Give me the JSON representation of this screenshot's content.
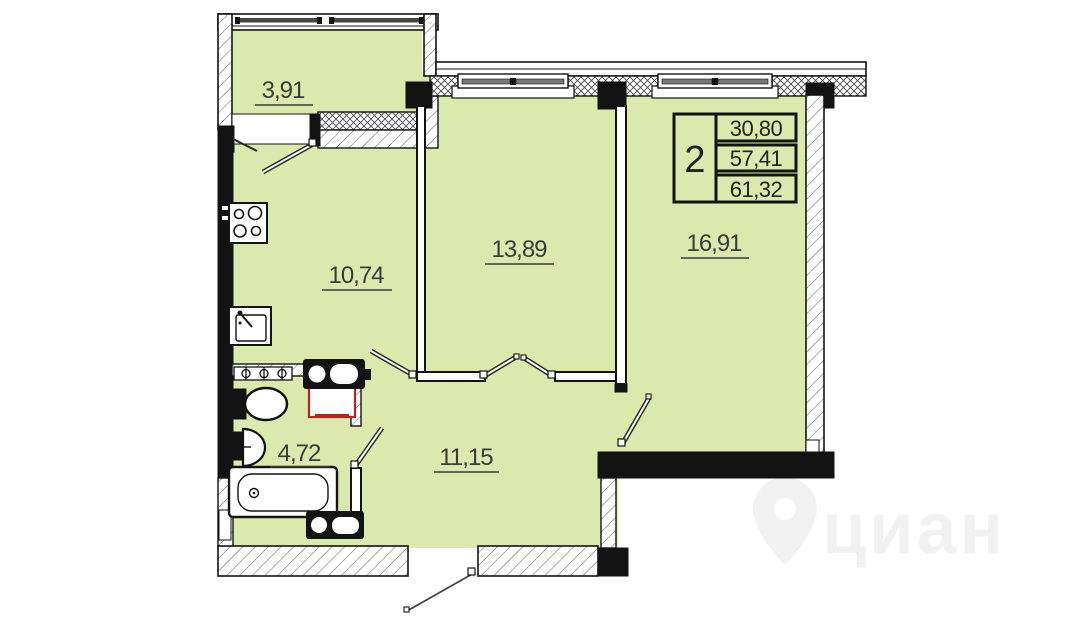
{
  "plan": {
    "areas": {
      "balcony": "3,91",
      "kitchen": "10,74",
      "living_room_1": "13,89",
      "living_room_2": "16,91",
      "bathroom": "4,72",
      "hallway": "11,15"
    },
    "info_table": {
      "rooms_count": "2",
      "values": [
        "30,80",
        "57,41",
        "61,32"
      ]
    },
    "watermark_text": "циан",
    "colors": {
      "room_fill": "#dce9ad",
      "wall_black": "#131313",
      "label_text": "#3b3b3b",
      "washer_accent": "#b3261e"
    }
  }
}
